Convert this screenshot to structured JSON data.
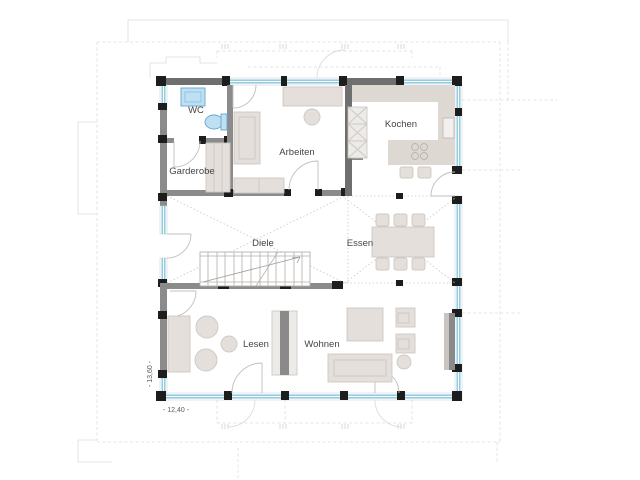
{
  "rooms": {
    "wc": {
      "label": "WC"
    },
    "garderobe": {
      "label": "Garderobe"
    },
    "arbeiten": {
      "label": "Arbeiten"
    },
    "kochen": {
      "label": "Kochen"
    },
    "diele": {
      "label": "Diele"
    },
    "essen": {
      "label": "Essen"
    },
    "lesen": {
      "label": "Lesen"
    },
    "wohnen": {
      "label": "Wohnen"
    }
  },
  "dimensions": {
    "width": "- 12,40 -",
    "height": "- 13,60 -"
  },
  "colors": {
    "wall": "#8b8b8b",
    "wall_dark": "#6f6f6f",
    "post": "#1d1d1d",
    "glass": "#7fc6de",
    "furniture_fill": "#e4dfda",
    "furniture_stroke": "#cfc8c2",
    "fixture_fill": "#bfe0f2",
    "fixture_stroke": "#63a9cf",
    "counter": "#ded8d3",
    "divider_dark": "#8a8a8a",
    "label_text": "#454545",
    "construction": "#dcdcdc",
    "stairs": "#b5b0ab"
  }
}
